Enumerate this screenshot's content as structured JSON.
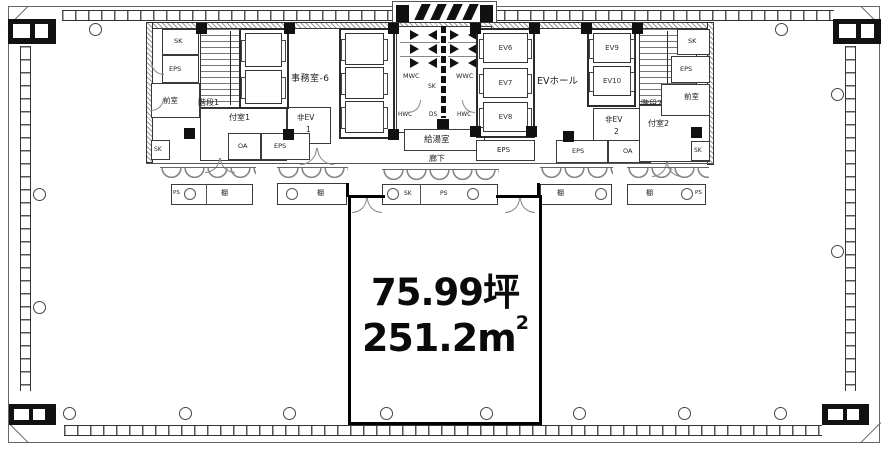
{
  "colors": {
    "ink": "#1a1a1a",
    "bold": "#000000",
    "gray": "#8a8a8a",
    "bg": "#ffffff"
  },
  "tenant": {
    "area_tsubo": "75.99坪",
    "area_sqm": "251.2m",
    "area_sqm_exp": "2"
  },
  "rooms": {
    "office": "事務室-6",
    "ev_hall": "EVホール",
    "stair1": "階段1",
    "stair2": "階段2",
    "vestibule1": "付室1",
    "vestibule2": "付室2",
    "anteroom_left": "前室",
    "anteroom_right": "前室",
    "kitchenette": "給湯室",
    "corridor": "廊下",
    "mwc": "MWC",
    "wwc": "WWC",
    "wc_sk": "SK",
    "hwc_left": "HWC",
    "ds": "DS",
    "hwc_right": "HWC"
  },
  "elevators": {
    "ev6": "EV6",
    "ev7": "EV7",
    "ev8": "EV8",
    "ev9": "EV9",
    "ev10": "EV10",
    "em1_name": "非EV",
    "em1_num": "1",
    "em2_name": "非EV",
    "em2_num": "2"
  },
  "service": {
    "sk_top_left": "SK",
    "eps_top_left": "EPS",
    "sk_bottom_left": "SK",
    "oa_left": "OA",
    "eps_left": "EPS",
    "eps_center": "EPS",
    "eps_right": "EPS",
    "oa_right": "OA",
    "sk_top_right": "SK",
    "eps_top_right": "EPS",
    "sk_bottom_right": "SK"
  },
  "corridor_units": {
    "ps_1": "PS",
    "shelf_1": "棚",
    "shelf_2": "棚",
    "sk_mid": "SK",
    "ps_mid": "PS",
    "shelf_3": "棚",
    "shelf_4": "棚",
    "ps_2": "PS"
  }
}
